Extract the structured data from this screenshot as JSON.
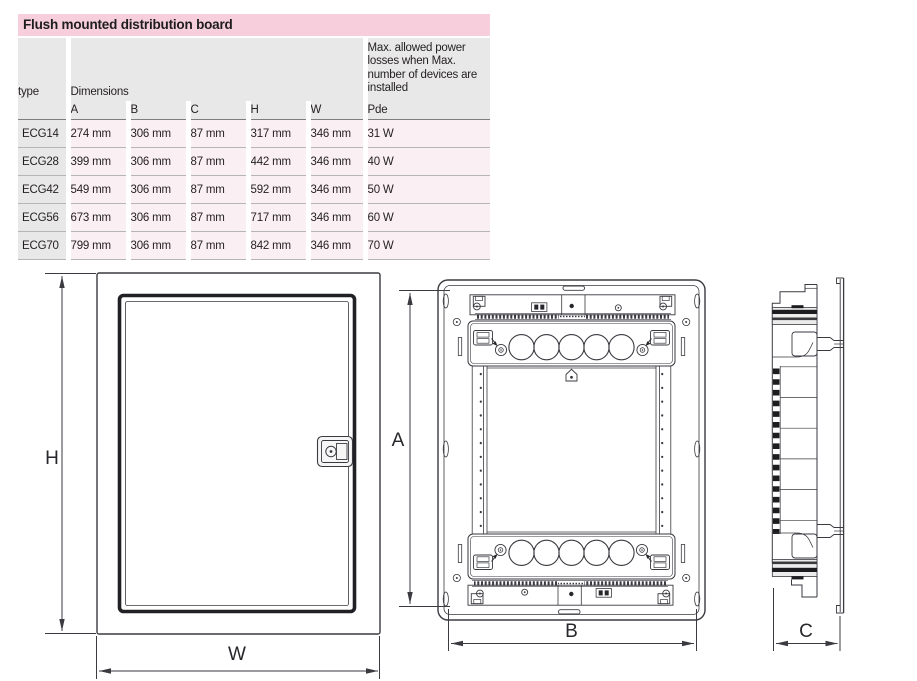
{
  "title_bar": {
    "label": "Flush mounted distribution board",
    "bg_color": "#f7cfdc"
  },
  "table": {
    "header": {
      "type_label": "type",
      "dimensions_label": "Dimensions",
      "power_label": "Max. allowed power losses when Max. number of devices are installed",
      "sub_columns": [
        "A",
        "B",
        "C",
        "H",
        "W"
      ],
      "power_sub_label": "Pde"
    },
    "rows": [
      {
        "type": "ECG14",
        "A": "274 mm",
        "B": "306 mm",
        "C": "87 mm",
        "H": "317 mm",
        "W": "346 mm",
        "Pde": "31 W"
      },
      {
        "type": "ECG28",
        "A": "399 mm",
        "B": "306 mm",
        "C": "87 mm",
        "H": "442 mm",
        "W": "346 mm",
        "Pde": "40 W"
      },
      {
        "type": "ECG42",
        "A": "549 mm",
        "B": "306 mm",
        "C": "87 mm",
        "H": "592 mm",
        "W": "346 mm",
        "Pde": "50 W"
      },
      {
        "type": "ECG56",
        "A": "673 mm",
        "B": "306 mm",
        "C": "87 mm",
        "H": "717 mm",
        "W": "346 mm",
        "Pde": "60 W"
      },
      {
        "type": "ECG70",
        "A": "799 mm",
        "B": "306 mm",
        "C": "87 mm",
        "H": "842 mm",
        "W": "346 mm",
        "Pde": "70 W"
      }
    ],
    "colors": {
      "header_bg": "#e8e8e8",
      "row_bg": "#faf0f4",
      "type_col_bg": "#e8e8e8",
      "separator": "#b5b5b5",
      "text": "#231f20"
    }
  },
  "drawings": {
    "front_view_with_door": {
      "height_label": "H",
      "width_label": "W"
    },
    "front_view_without_door": {
      "height_label": "A",
      "width_label": "B"
    },
    "side_view": {
      "depth_label": "C"
    },
    "line_color": "#3a3a40"
  }
}
